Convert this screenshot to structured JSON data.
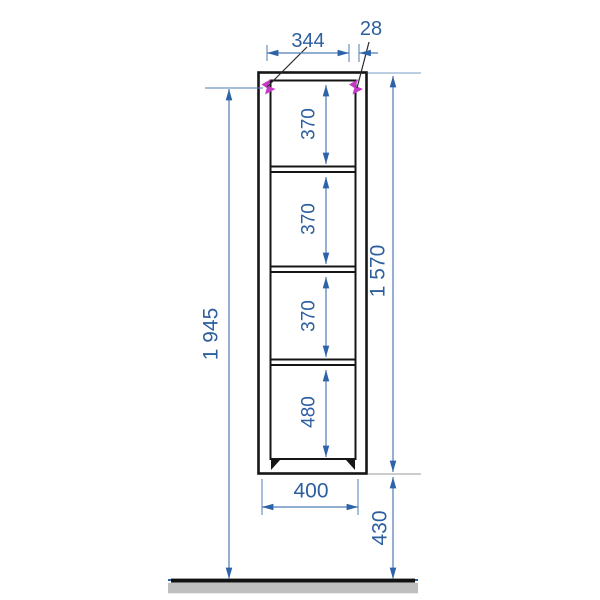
{
  "drawing": {
    "kind": "furniture dimension drawing",
    "labels": {
      "top_width": "344",
      "hanger_inset": "28",
      "total_height": "1 945",
      "side_height": "1 570",
      "shelf_1": "370",
      "shelf_2": "370",
      "shelf_3": "370",
      "shelf_4": "480",
      "base_width": "400",
      "floor_clearance": "430"
    },
    "colors": {
      "dimension_blue": "#2e63a8",
      "text_blue": "#2d5f9f",
      "frame_black": "#161616",
      "hanger_magenta": "#c639c6",
      "ground_gray": "#bfbfbf"
    }
  }
}
